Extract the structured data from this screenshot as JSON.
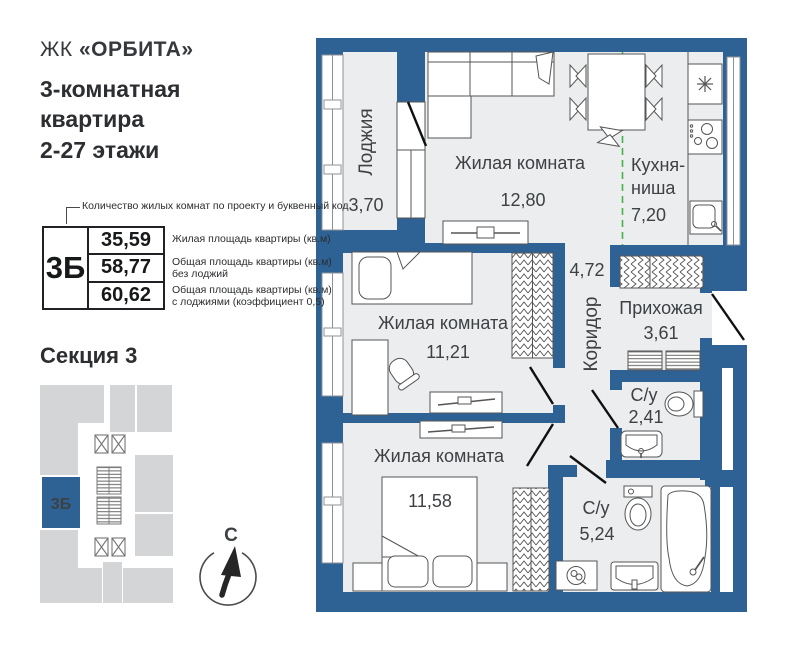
{
  "brand": {
    "prefix": "ЖК",
    "name": "«ОРБИТА»"
  },
  "title": "3-комнатная\nквартира\n2-27 этажи",
  "legend": {
    "callout": "Количество жилых комнат по проекту и буквенный код",
    "code": "3Б",
    "rows": [
      {
        "value": "35,59",
        "label": "Жилая площадь квартиры (кв.м)"
      },
      {
        "value": "58,77",
        "label": "Общая площадь квартиры (кв.м)\nбез лоджий"
      },
      {
        "value": "60,62",
        "label": "Общая площадь квартиры (кв.м)\nс лоджиями (коэффициент 0,5)"
      }
    ]
  },
  "section": {
    "title": "Секция 3",
    "code": "3Б"
  },
  "compass": {
    "north": "С"
  },
  "plan": {
    "loggia": {
      "name": "Лоджия",
      "area": "3,70"
    },
    "living": {
      "name": "Жилая комната",
      "area": "12,80"
    },
    "kitchen": {
      "name_line1": "Кухня-",
      "name_line2": "ниша",
      "area": "7,20"
    },
    "corridor": {
      "name": "Коридор",
      "area": "4,72"
    },
    "hall": {
      "name": "Прихожая",
      "area": "3,61"
    },
    "bedroom2": {
      "name": "Жилая комната",
      "area": "11,21"
    },
    "bath_small": {
      "name": "С/у",
      "area": "2,41"
    },
    "bedroom3": {
      "name": "Жилая комната",
      "area": "11,58"
    },
    "bath_big": {
      "name": "С/у",
      "area": "5,24"
    }
  },
  "colors": {
    "wall": "#2e6295",
    "room": "#ebedee",
    "minimap_gray": "#d3d5d6",
    "highlight": "#2e6295",
    "dashed_divider": "#47b14b"
  }
}
